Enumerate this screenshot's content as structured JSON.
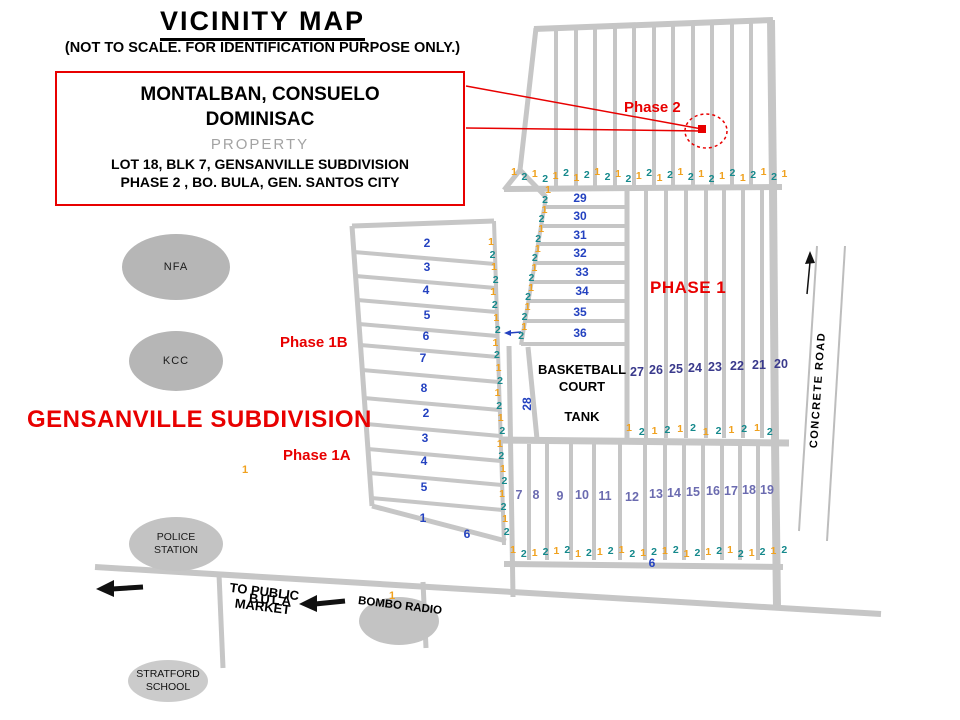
{
  "header": {
    "title": "VICINITY MAP",
    "subtitle": "(NOT TO SCALE. FOR IDENTIFICATION PURPOSE ONLY.)"
  },
  "info_box": {
    "owner_line1": "MONTALBAN, CONSUELO",
    "owner_line2": "DOMINISAC",
    "property": "PROPERTY",
    "lot_line": "LOT 18, BLK 7, GENSANVILLE SUBDIVISION",
    "phase_line": "PHASE 2 , BO. BULA,  GEN. SANTOS CITY"
  },
  "map_labels": {
    "subdivision": "GENSANVILLE SUBDIVISION",
    "phase2": "Phase 2",
    "phase1": "PHASE 1",
    "phase1b": "Phase 1B",
    "phase1a": "Phase 1A",
    "basketball_line1": "BASKETBALL",
    "basketball_line2": "COURT",
    "tank": "TANK",
    "concrete_road": "CONCRETE ROAD",
    "to_public_market_line1": "TO PUBLIC",
    "to_public_market_line2": "MARKET",
    "bula": "BULA",
    "bombo_radio": "BOMBO RADIO"
  },
  "landmarks": {
    "nfa": {
      "label": "NFA"
    },
    "kcc": {
      "label": "KCC"
    },
    "police": {
      "line1": "POLICE",
      "line2": "STATION"
    },
    "stratford": {
      "line1": "STRATFORD",
      "line2": "SCHOOL"
    }
  },
  "colors": {
    "red": "#e80000",
    "road": "#c6c6c6",
    "orange": "#f0a11e",
    "teal": "#15898c",
    "blue": "#2442c0",
    "navy": "#3a3a8c",
    "purple": "#6b6bb0",
    "black": "#111111"
  },
  "lot_numbers": {
    "groups": [
      {
        "name": "phase1b-lots",
        "color": "#2442c0",
        "size": 12,
        "items": [
          {
            "v": "2",
            "x": 427,
            "y": 243
          },
          {
            "v": "3",
            "x": 427,
            "y": 267
          },
          {
            "v": "4",
            "x": 426,
            "y": 290
          },
          {
            "v": "5",
            "x": 427,
            "y": 315
          },
          {
            "v": "6",
            "x": 426,
            "y": 336
          },
          {
            "v": "7",
            "x": 423,
            "y": 358
          },
          {
            "v": "8",
            "x": 424,
            "y": 388
          },
          {
            "v": "2",
            "x": 426,
            "y": 413
          },
          {
            "v": "3",
            "x": 425,
            "y": 438
          },
          {
            "v": "4",
            "x": 424,
            "y": 461
          },
          {
            "v": "5",
            "x": 424,
            "y": 487
          },
          {
            "v": "1",
            "x": 423,
            "y": 518
          },
          {
            "v": "6",
            "x": 467,
            "y": 534
          }
        ]
      },
      {
        "name": "block-29-36",
        "color": "#2442c0",
        "size": 12,
        "items": [
          {
            "v": "29",
            "x": 580,
            "y": 198
          },
          {
            "v": "30",
            "x": 580,
            "y": 216
          },
          {
            "v": "31",
            "x": 580,
            "y": 235
          },
          {
            "v": "32",
            "x": 580,
            "y": 253
          },
          {
            "v": "33",
            "x": 582,
            "y": 272
          },
          {
            "v": "34",
            "x": 582,
            "y": 291
          },
          {
            "v": "35",
            "x": 580,
            "y": 312
          },
          {
            "v": "36",
            "x": 580,
            "y": 333
          }
        ]
      },
      {
        "name": "block-20-27",
        "color": "#3a3a8c",
        "size": 12.5,
        "items": [
          {
            "v": "27",
            "x": 637,
            "y": 372
          },
          {
            "v": "26",
            "x": 656,
            "y": 370
          },
          {
            "v": "25",
            "x": 676,
            "y": 369
          },
          {
            "v": "24",
            "x": 695,
            "y": 368
          },
          {
            "v": "23",
            "x": 715,
            "y": 367
          },
          {
            "v": "22",
            "x": 737,
            "y": 366
          },
          {
            "v": "21",
            "x": 759,
            "y": 365
          },
          {
            "v": "20",
            "x": 781,
            "y": 364
          }
        ]
      },
      {
        "name": "block-7-19",
        "color": "#6b6bb0",
        "size": 12.5,
        "items": [
          {
            "v": "7",
            "x": 519,
            "y": 495
          },
          {
            "v": "8",
            "x": 536,
            "y": 495
          },
          {
            "v": "9",
            "x": 560,
            "y": 496
          },
          {
            "v": "10",
            "x": 582,
            "y": 495
          },
          {
            "v": "11",
            "x": 605,
            "y": 496
          },
          {
            "v": "12",
            "x": 632,
            "y": 497
          },
          {
            "v": "13",
            "x": 656,
            "y": 494
          },
          {
            "v": "14",
            "x": 674,
            "y": 493
          },
          {
            "v": "15",
            "x": 693,
            "y": 492
          },
          {
            "v": "16",
            "x": 713,
            "y": 491
          },
          {
            "v": "17",
            "x": 731,
            "y": 491
          },
          {
            "v": "18",
            "x": 749,
            "y": 490
          },
          {
            "v": "19",
            "x": 767,
            "y": 490
          }
        ]
      },
      {
        "name": "block-28",
        "color": "#2442c0",
        "size": 12,
        "rotate": true,
        "items": [
          {
            "v": "28",
            "x": 527,
            "y": 404
          }
        ]
      },
      {
        "name": "lot-6-bottom",
        "color": "#2442c0",
        "size": 12,
        "items": [
          {
            "v": "6",
            "x": 652,
            "y": 563
          }
        ]
      },
      {
        "name": "stray-marks",
        "color": "#f0a11e",
        "size": 11,
        "items": [
          {
            "v": "1",
            "x": 245,
            "y": 470
          },
          {
            "v": "1",
            "x": 392,
            "y": 596
          }
        ]
      }
    ]
  },
  "dimension_groups": [
    {
      "name": "phase2-frontage",
      "type": "row",
      "sequence": "121212121212121212121212121",
      "x0": 514,
      "dx": 10.4,
      "y0": 176,
      "jitter": 8
    },
    {
      "name": "block-29-36-frontage",
      "type": "pairs",
      "count": 8,
      "x0": 548,
      "dx": -3.4,
      "y0": 190,
      "dy": 19.5,
      "gapx": -3,
      "gapy": 9.5
    },
    {
      "name": "phase1b-frontage",
      "type": "col",
      "sequence": "121212121212121212121212",
      "x0": 493,
      "dx": 0.55,
      "y0": 242,
      "dy": 12.6,
      "jitter": 4
    },
    {
      "name": "phase1-mid-frontage",
      "type": "row",
      "sequence": "121212121212",
      "x0": 629,
      "dx": 12.8,
      "y0": 430,
      "jitter": 5
    },
    {
      "name": "phase1-bottom-frontage",
      "type": "row",
      "sequence": "12121212121212121212121212",
      "x0": 513,
      "dx": 10.85,
      "y0": 552,
      "jitter": 5
    }
  ]
}
